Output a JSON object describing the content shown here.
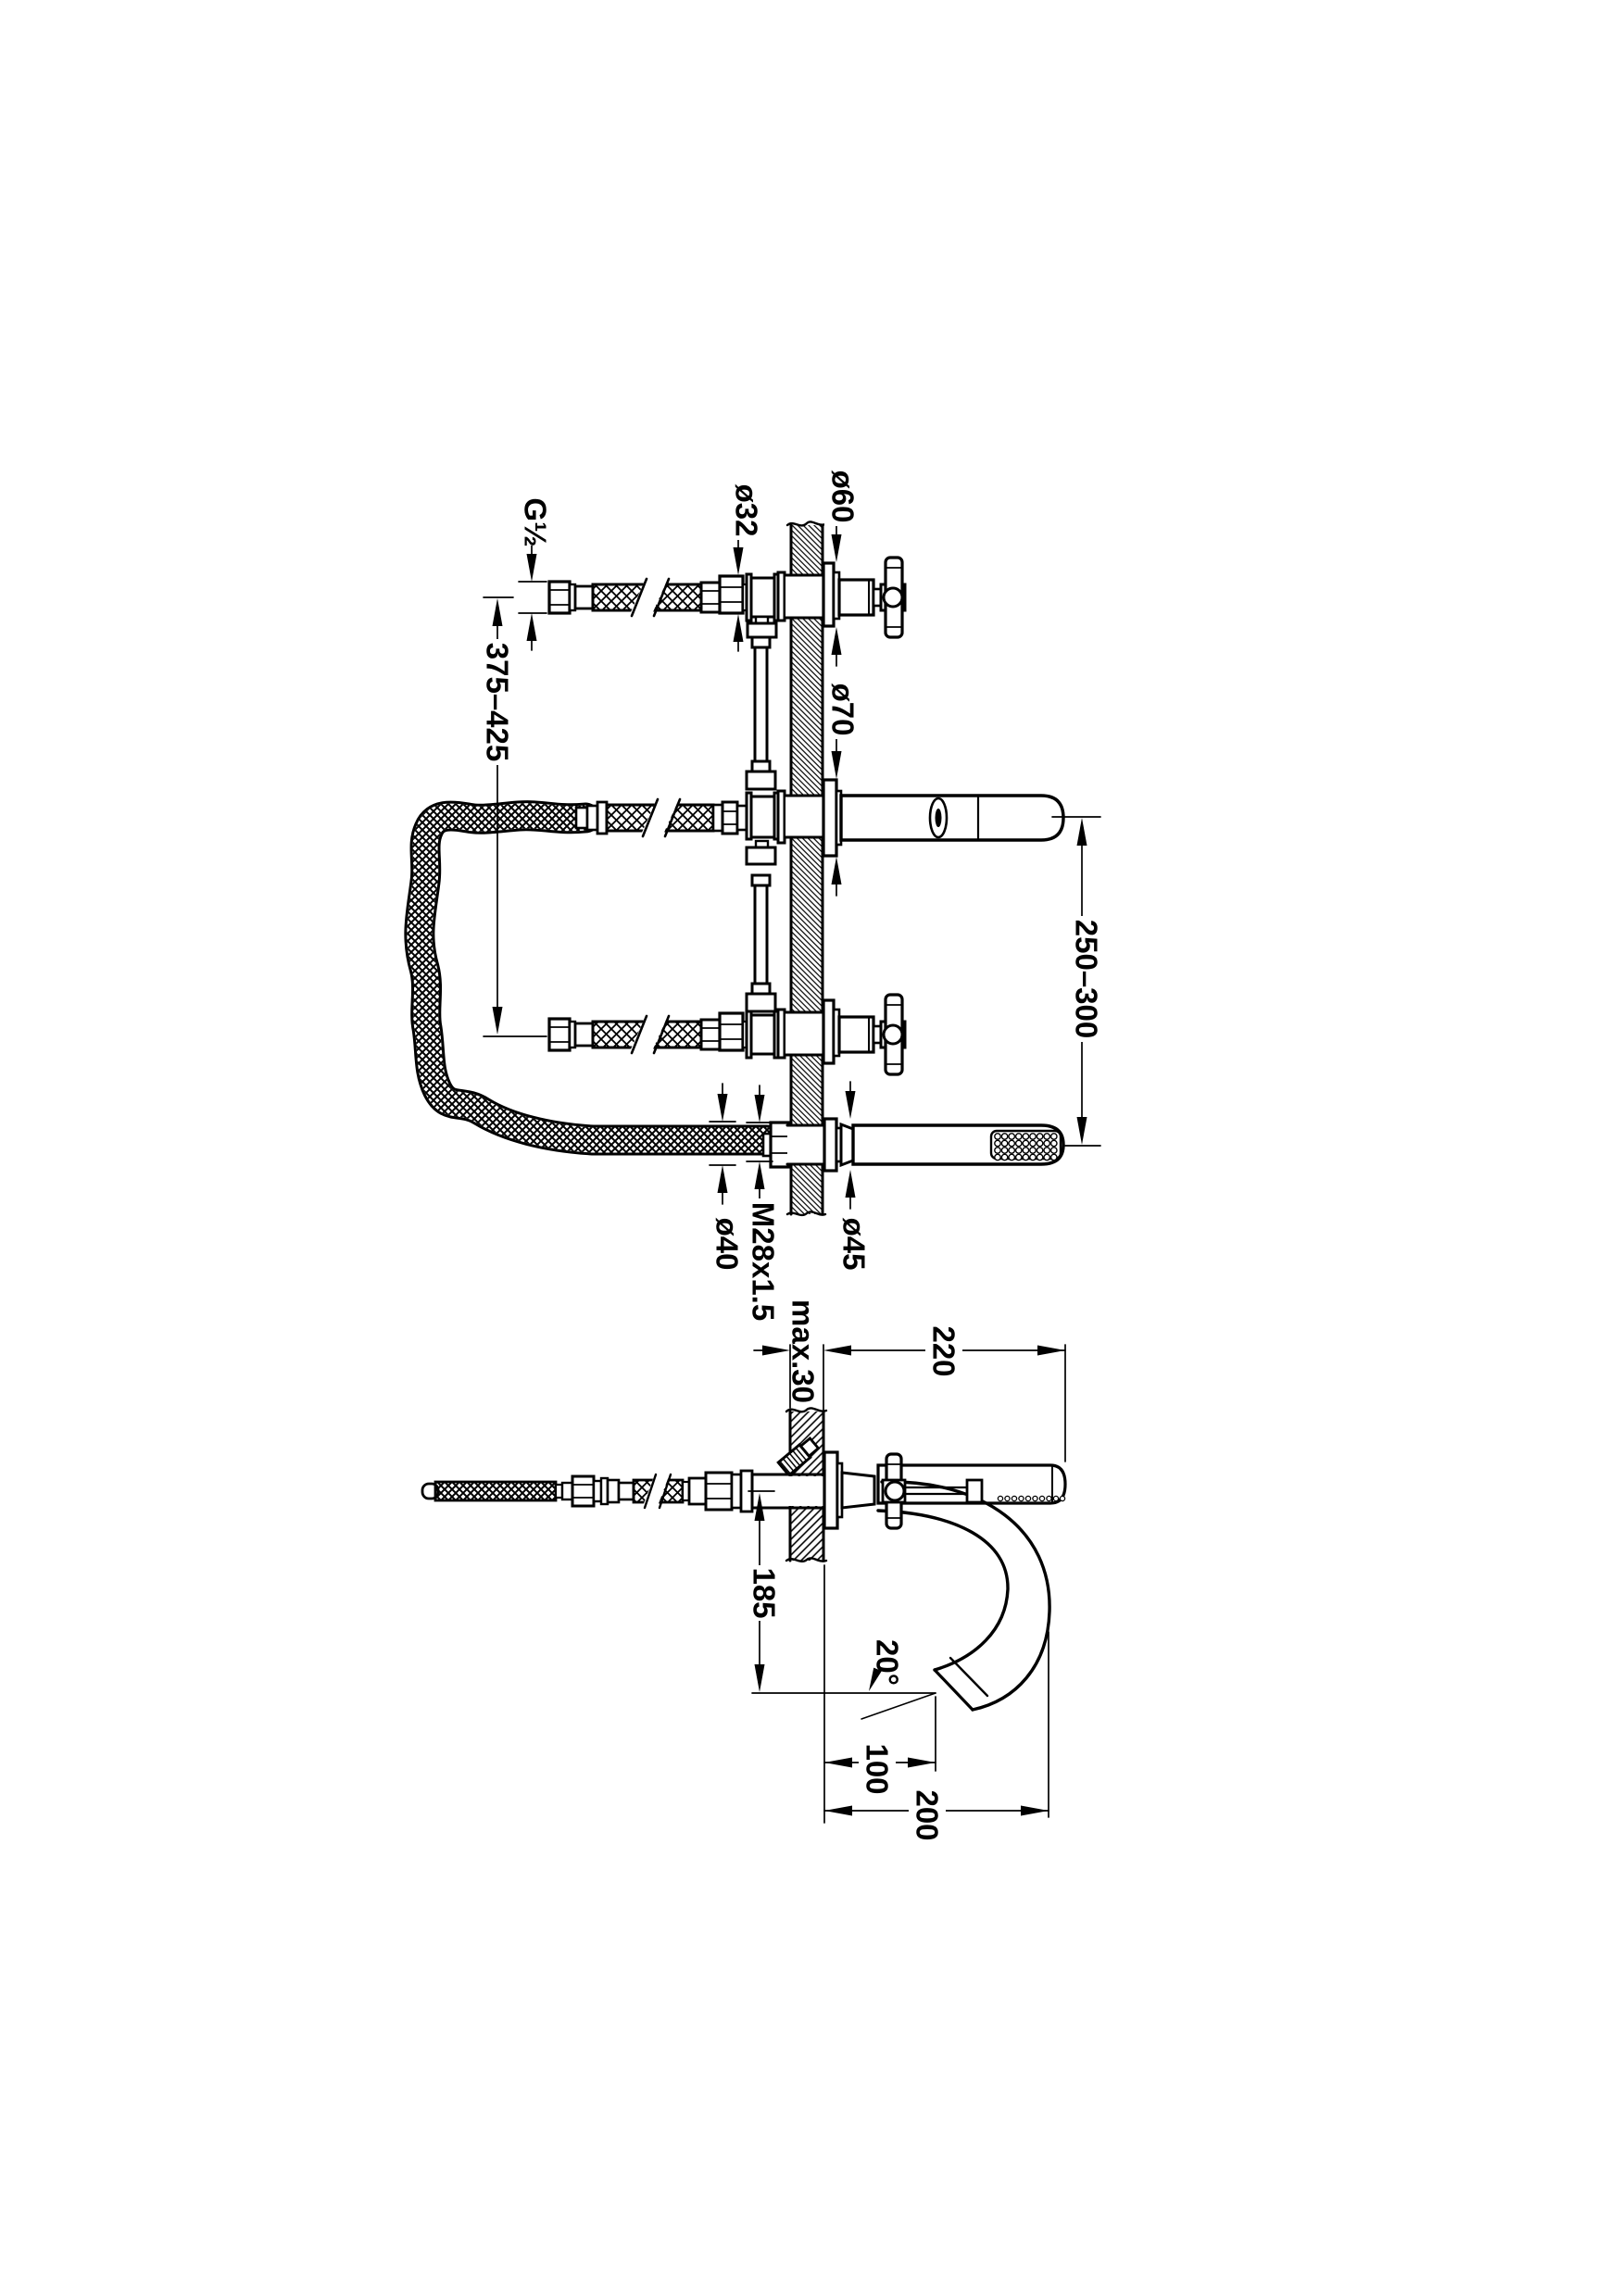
{
  "drawing": {
    "background": "#ffffff",
    "ink": "#000000",
    "type": "bath-mixer-installation-drawing",
    "front_view": {
      "labels": {
        "g_half": "G½",
        "dia32": "ø32",
        "dia60": "ø60",
        "dia70": "ø70",
        "span_375_425": "375–425",
        "span_250_300": "250–300",
        "dia40": "ø40",
        "m28": "M28x1.5",
        "dia45": "ø45"
      }
    },
    "side_view": {
      "labels": {
        "max30": "max.30",
        "reach220": "220",
        "drop185": "185",
        "angle20": "20°",
        "offset100": "100",
        "reach200": "200"
      }
    }
  }
}
